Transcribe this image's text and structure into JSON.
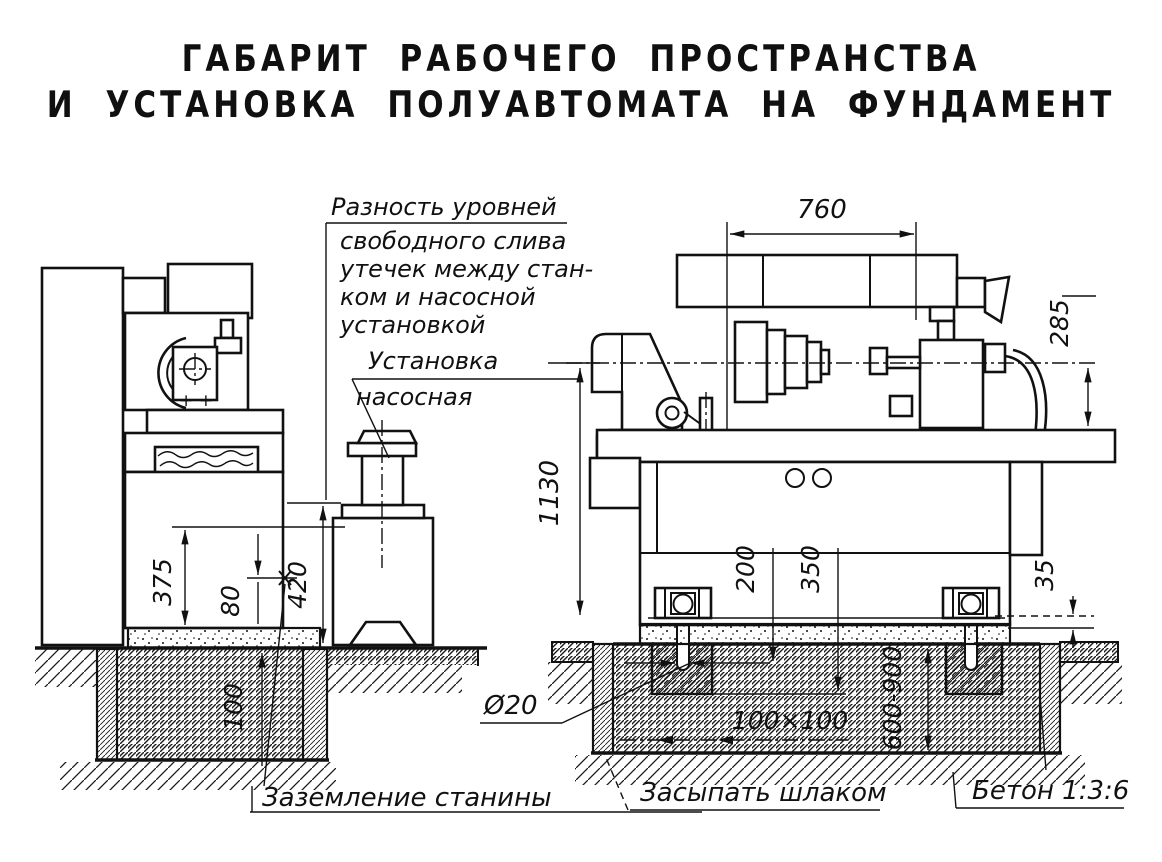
{
  "title": {
    "line1": "ГАБАРИТ РАБОЧЕГО ПРОСТРАНСТВА",
    "line2": "И УСТАНОВКА ПОЛУАВТОМАТА НА ФУНДАМЕНТ"
  },
  "annotations": {
    "level_difference_line1": "Разность уровней",
    "level_difference_line2": "свободного слива",
    "level_difference_line3": "утечек между стан-",
    "level_difference_line4": "ком и насосной",
    "level_difference_line5": "установкой",
    "pump_unit_line1": "Установка",
    "pump_unit_line2": "насосная",
    "bed_grounding": "Заземление станины",
    "slag_fill": "Засыпать шлаком",
    "concrete_mix": "Бетон 1:3:6",
    "anchor_bolt_diameter": "Ø20",
    "bolt_pocket_size": "100×100",
    "head_marks": "+ +"
  },
  "dimensions": {
    "left_view": {
      "drain_height": "375",
      "gap": "80",
      "pump_level_difference": "420",
      "pit_depth": "100"
    },
    "right_view": {
      "spindle_spacing": "760",
      "center_to_table": "285",
      "center_height": "1130",
      "pocket_depth_1": "200",
      "pocket_depth_2": "350",
      "leveling_gap": "35",
      "foundation_depth": "600-900"
    }
  }
}
